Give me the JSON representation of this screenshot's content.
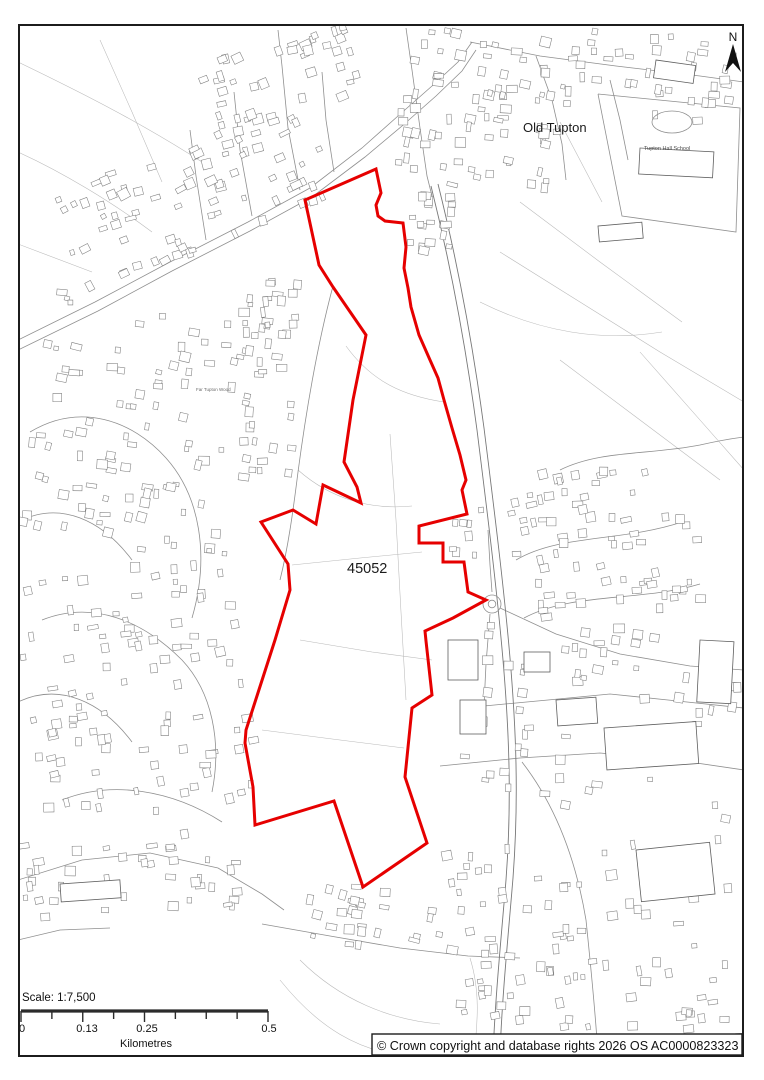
{
  "map": {
    "site_label": "45052",
    "place_labels": {
      "old_tupton": "Old Tupton",
      "tupton_hall_school": "Tupton Hall School",
      "far_tupton_wood": "Far Tupton Wood"
    },
    "boundary_color": "#e60000",
    "frame_color": "#1c1c1c",
    "site_boundary": [
      [
        376,
        169
      ],
      [
        381,
        193
      ],
      [
        376,
        205
      ],
      [
        378,
        216
      ],
      [
        385,
        221
      ],
      [
        403,
        223
      ],
      [
        406,
        247
      ],
      [
        404,
        268
      ],
      [
        408,
        288
      ],
      [
        411,
        307
      ],
      [
        419,
        335
      ],
      [
        430,
        360
      ],
      [
        438,
        378
      ],
      [
        444,
        400
      ],
      [
        452,
        428
      ],
      [
        460,
        455
      ],
      [
        466,
        480
      ],
      [
        462,
        490
      ],
      [
        467,
        514
      ],
      [
        419,
        526
      ],
      [
        419,
        543
      ],
      [
        443,
        543
      ],
      [
        443,
        562
      ],
      [
        464,
        562
      ],
      [
        468,
        592
      ],
      [
        486,
        600
      ],
      [
        453,
        618
      ],
      [
        425,
        631
      ],
      [
        426,
        641
      ],
      [
        432,
        695
      ],
      [
        412,
        708
      ],
      [
        405,
        777
      ],
      [
        427,
        843
      ],
      [
        363,
        887
      ],
      [
        334,
        801
      ],
      [
        255,
        825
      ],
      [
        253,
        787
      ],
      [
        245,
        743
      ],
      [
        246,
        730
      ],
      [
        275,
        640
      ],
      [
        290,
        590
      ],
      [
        288,
        564
      ],
      [
        261,
        522
      ],
      [
        293,
        510
      ],
      [
        316,
        524
      ],
      [
        323,
        485
      ],
      [
        361,
        503
      ],
      [
        357,
        487
      ],
      [
        344,
        462
      ],
      [
        353,
        400
      ],
      [
        366,
        335
      ],
      [
        333,
        287
      ],
      [
        319,
        265
      ],
      [
        305,
        200
      ]
    ]
  },
  "north_arrow_label": "N",
  "scale_bar": {
    "title": "Scale: 1:7,500",
    "tick_labels": [
      "0",
      "0.13",
      "0.25",
      "0.5"
    ],
    "unit_label": "Kilometres"
  },
  "copyright_text": "© Crown copyright and database rights 2026 OS AC0000823323"
}
